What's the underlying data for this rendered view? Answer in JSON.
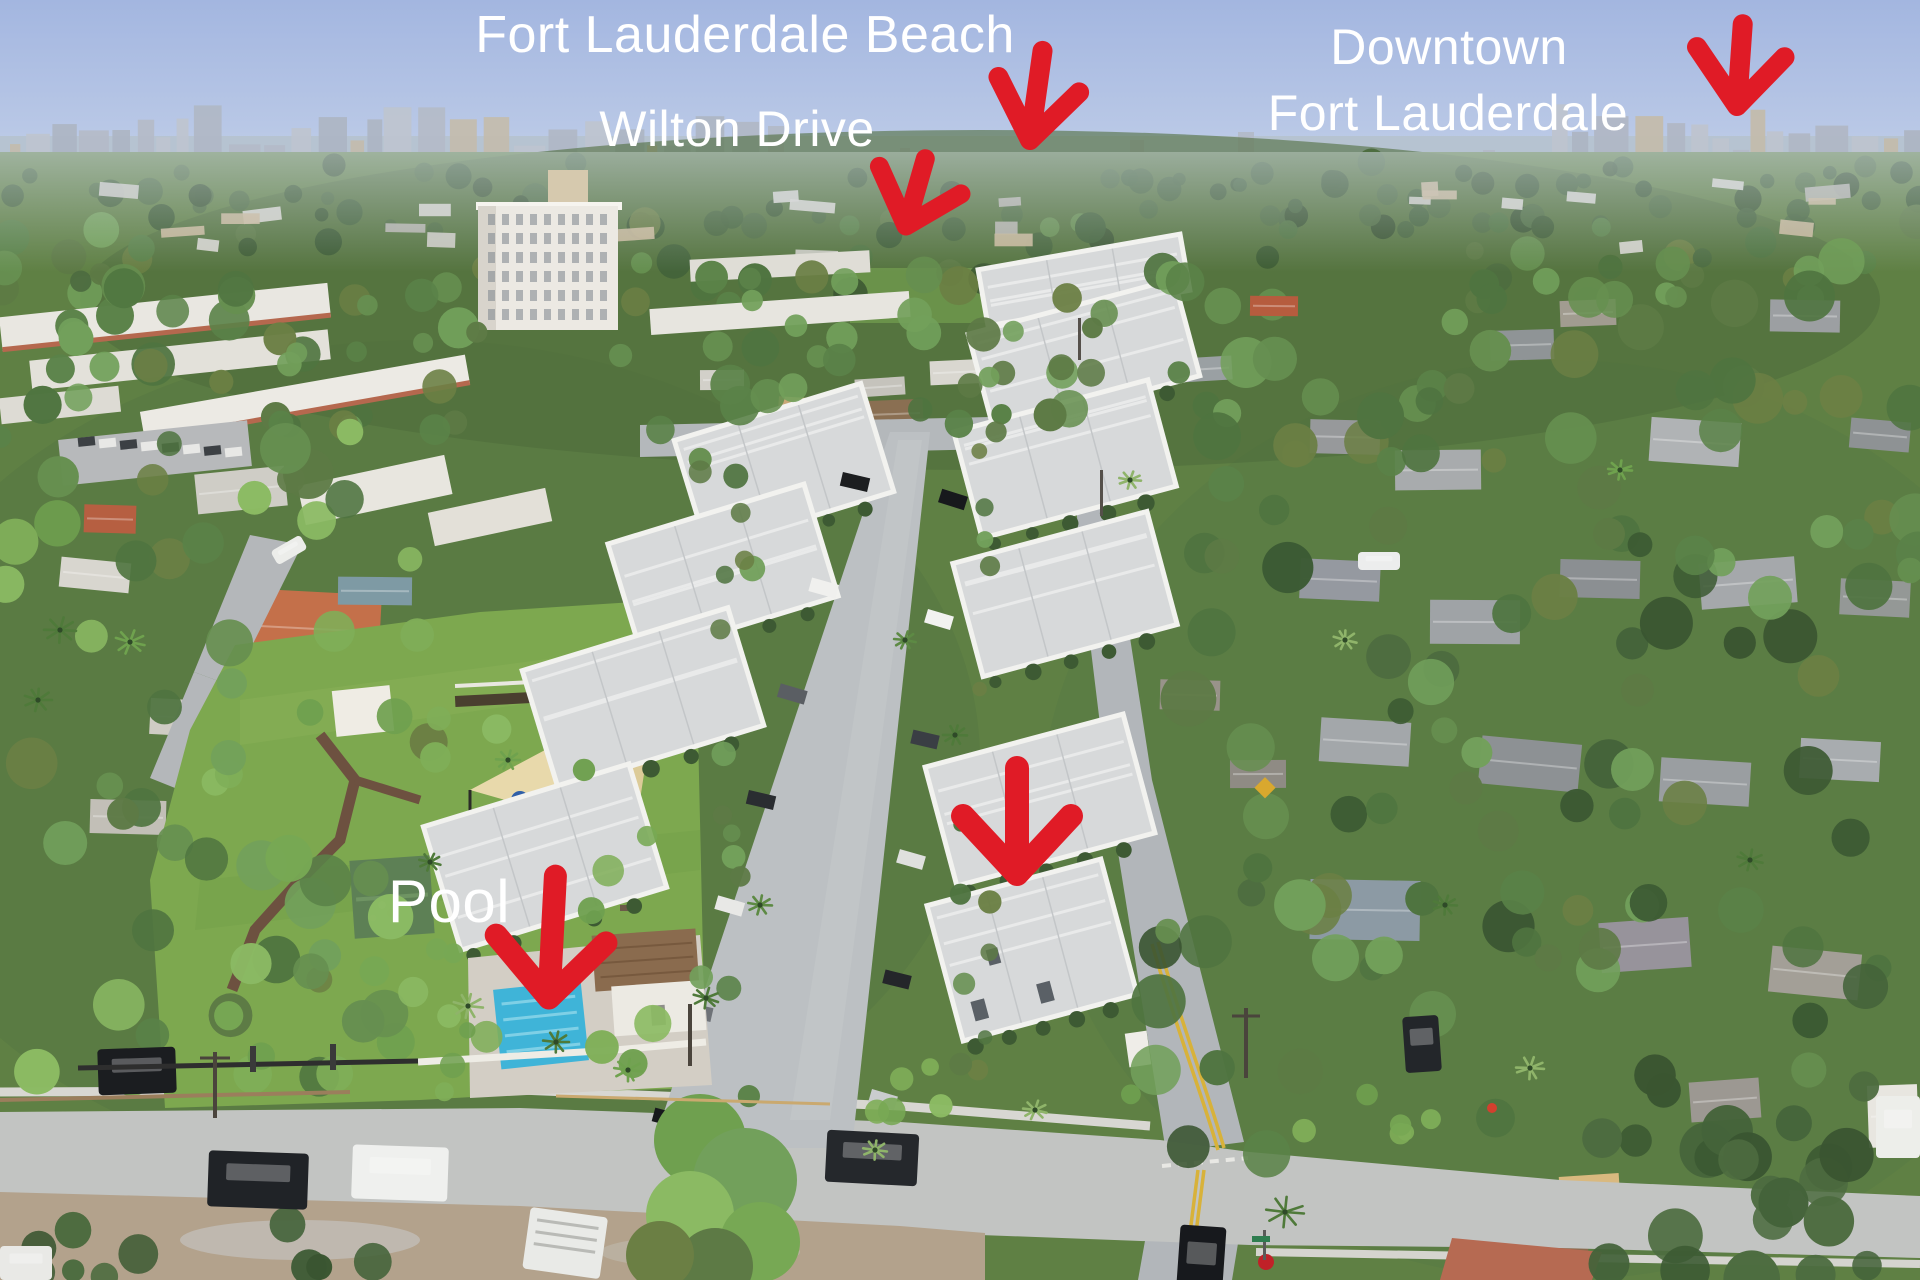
{
  "scene": {
    "type": "annotated-aerial-photograph",
    "description": "Aerial drone view of a residential neighborhood with a white townhome community, park, playground and pool, looking toward the coastal skyline"
  },
  "annotations": {
    "labels": [
      {
        "id": "fort-lauderdale-beach",
        "text": "Fort Lauderdale Beach"
      },
      {
        "id": "wilton-drive",
        "text": "Wilton Drive"
      },
      {
        "id": "downtown-line-1",
        "text": "Downtown"
      },
      {
        "id": "downtown-line-2",
        "text": "Fort Lauderdale"
      },
      {
        "id": "pool",
        "text": "Pool"
      }
    ],
    "arrows": [
      {
        "id": "fort-lauderdale-beach-arrow",
        "direction": "down"
      },
      {
        "id": "wilton-drive-arrow",
        "direction": "down"
      },
      {
        "id": "downtown-fort-lauderdale-arrow",
        "direction": "down"
      },
      {
        "id": "property-arrow",
        "direction": "down"
      },
      {
        "id": "pool-arrow",
        "direction": "down"
      }
    ]
  },
  "colors": {
    "arrow_red": "#e01b26",
    "label_white": "#ffffff",
    "sky_top": "#a3b6e0",
    "sky_horizon": "#c9d5ea",
    "ocean": "#b6c3d1",
    "pool_water": "#3fb4d8",
    "lawn_green": "#7da84f"
  }
}
